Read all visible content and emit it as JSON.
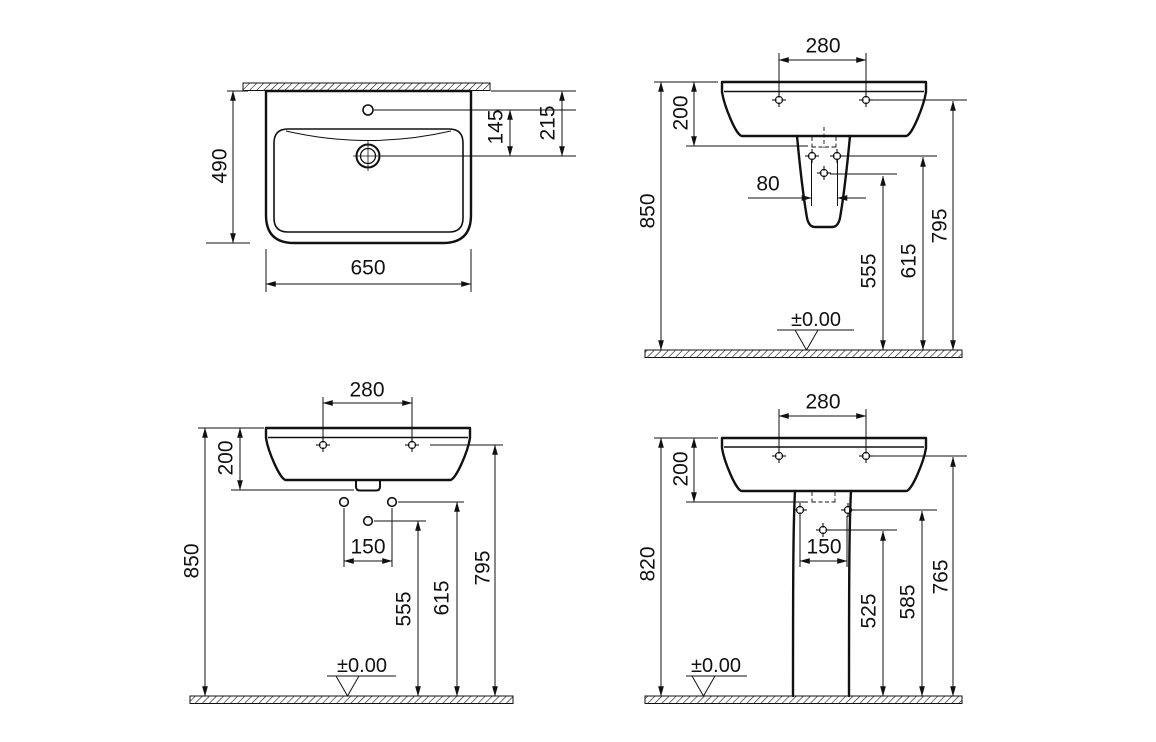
{
  "colors": {
    "line": "#111111",
    "background": "#ffffff"
  },
  "views": {
    "plan": {
      "depth": "490",
      "width": "650",
      "tap_to_drain": "145",
      "wall_to_drain": "215"
    },
    "semi_pedestal": {
      "fixing_hole_spacing": "280",
      "basin_height": "200",
      "rim_height": "850",
      "outlet_spacing": "80",
      "trap_height": "555",
      "pedestal_fixing_height": "615",
      "fixing_hole_height": "795",
      "floor_datum": "±0.00"
    },
    "wall_hung": {
      "fixing_hole_spacing": "280",
      "basin_height": "200",
      "rim_height": "850",
      "bracket_spacing": "150",
      "trap_height": "555",
      "bracket_height": "615",
      "fixing_hole_height": "795",
      "floor_datum": "±0.00"
    },
    "pedestal": {
      "fixing_hole_spacing": "280",
      "basin_height": "200",
      "rim_height": "820",
      "bolt_spacing": "150",
      "trap_height": "525",
      "bolt_height": "585",
      "fixing_hole_height": "765",
      "floor_datum": "±0.00"
    }
  }
}
